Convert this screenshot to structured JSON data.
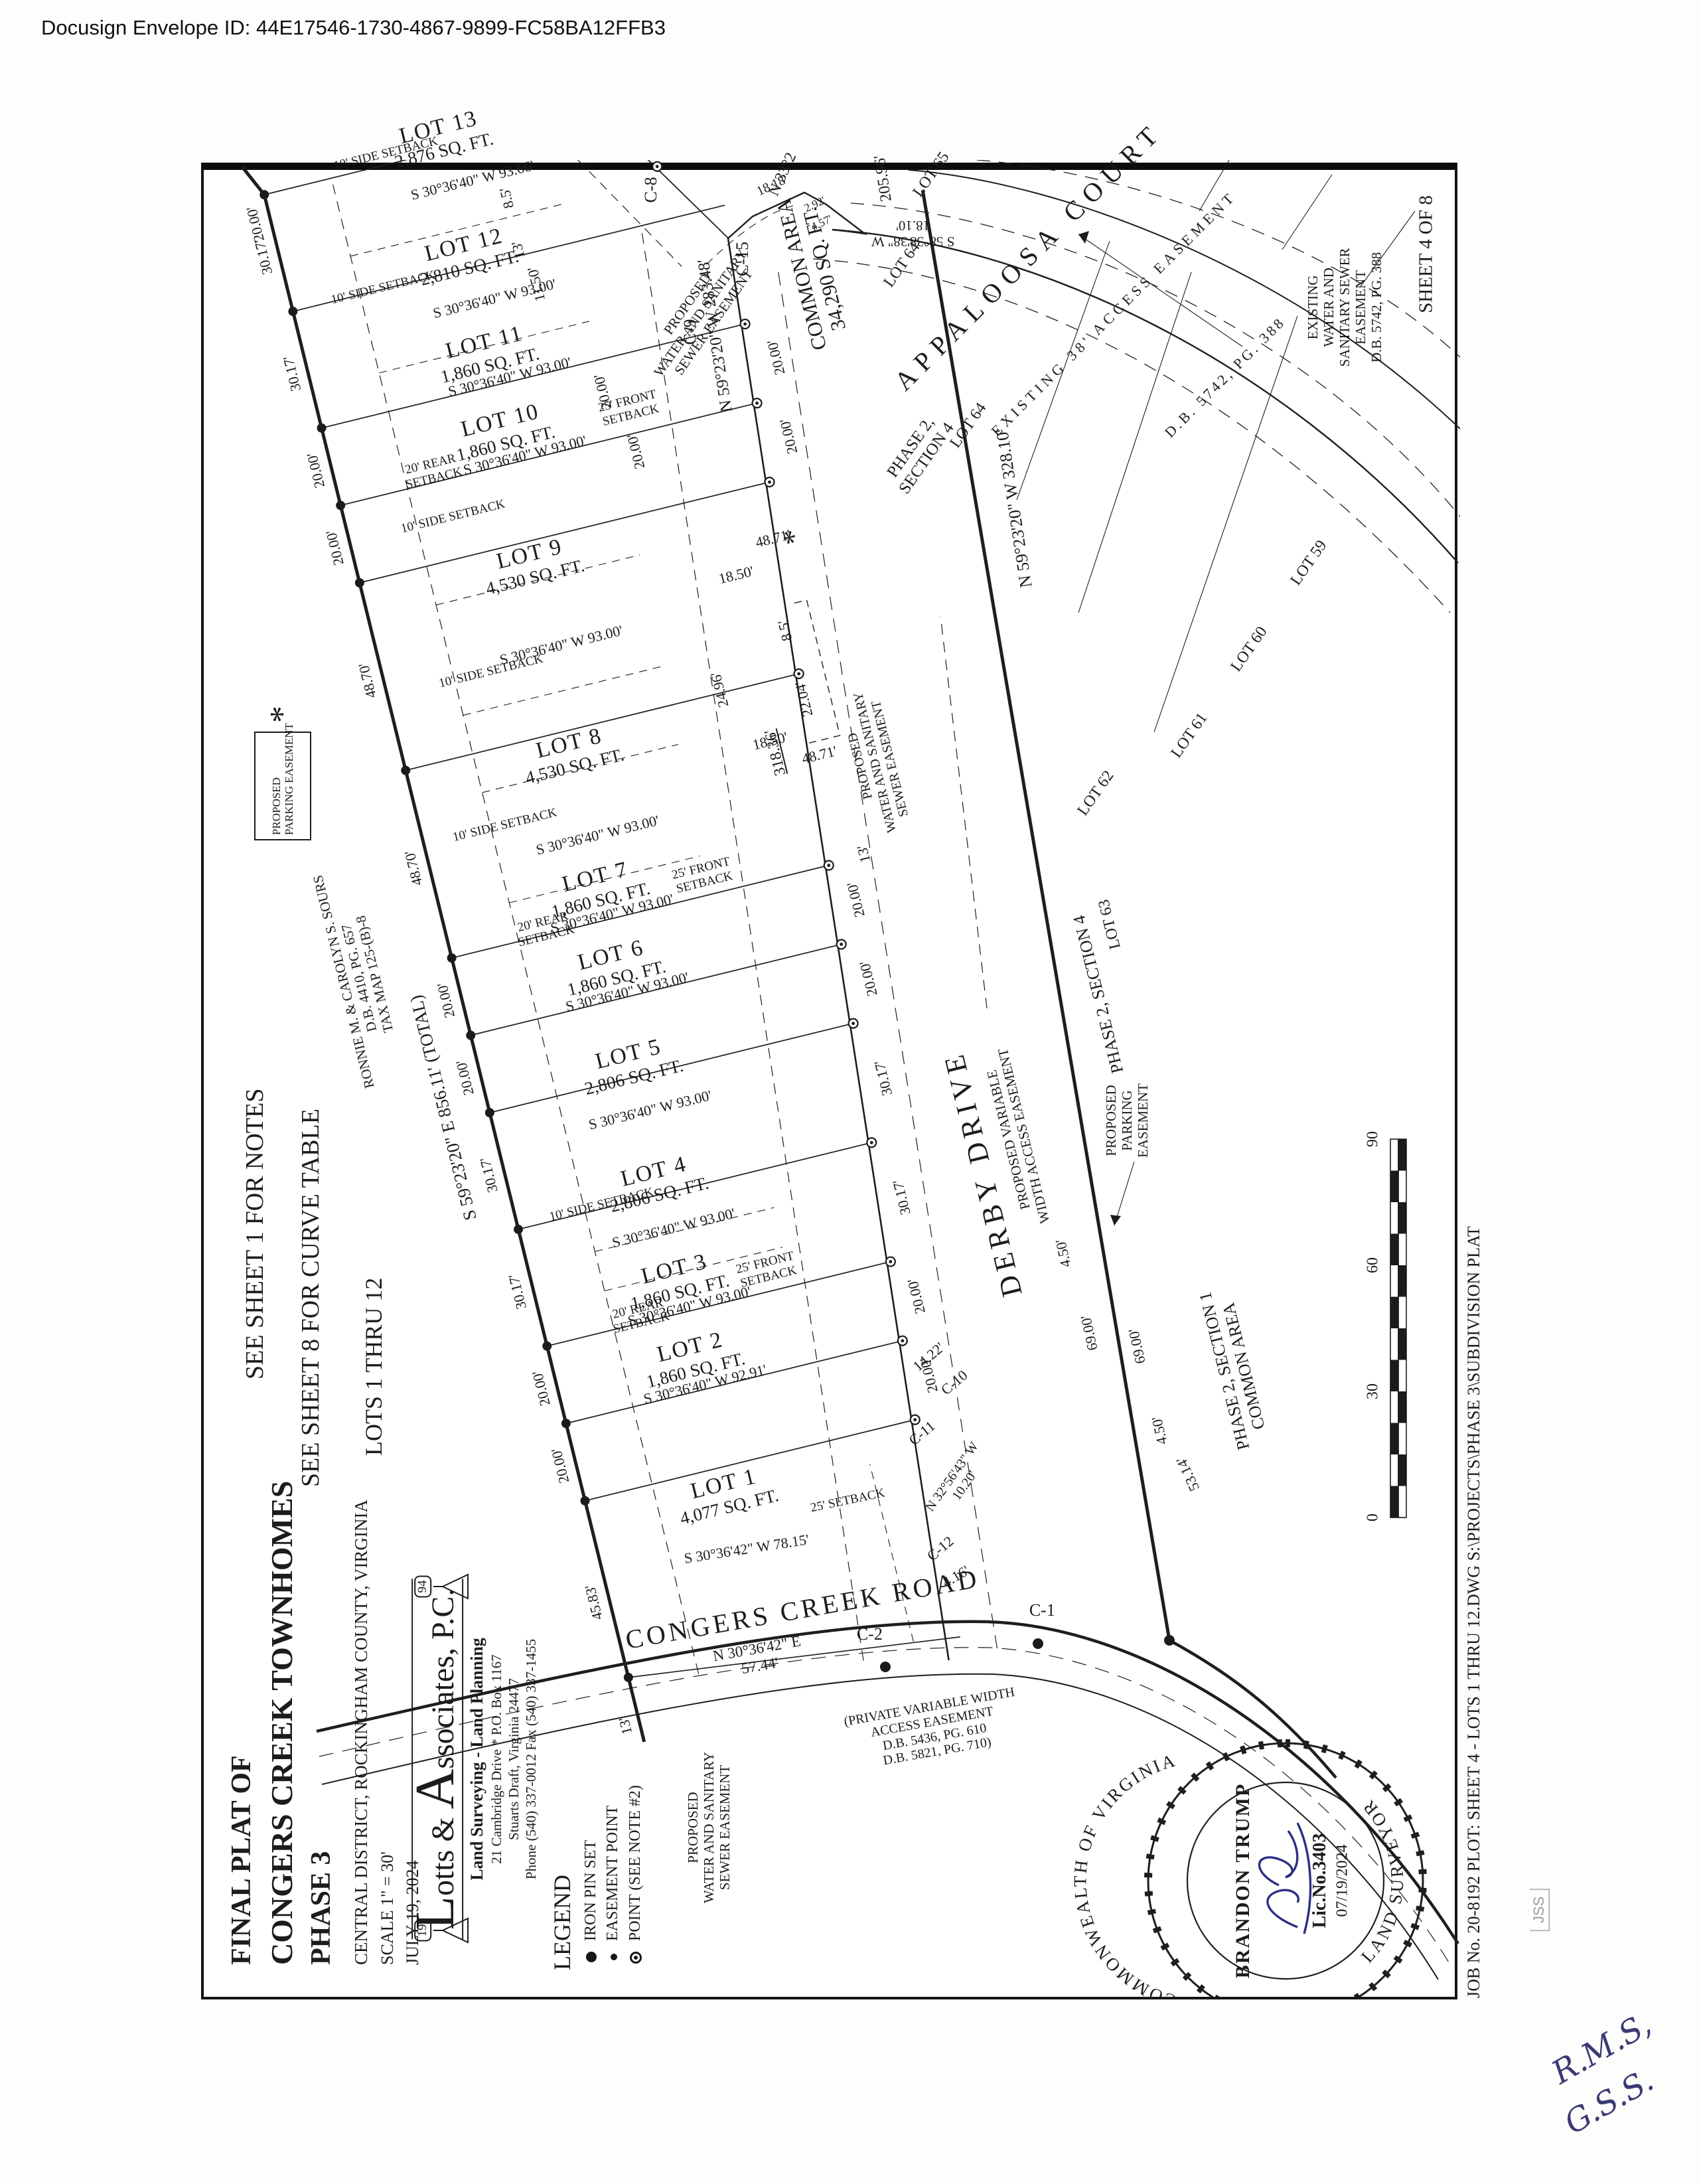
{
  "page": {
    "docusign_id": "Docusign Envelope ID: 44E17546-1730-4867-9899-FC58BA12FFB3",
    "sheet_label": "SHEET 4 OF 8",
    "job_line": "JOB No. 20-8192   PLOT: SHEET 4 - LOTS 1 THRU 12.DWG S:\\PROJECTS\\PHASE 3\\SUBDIVISION PLAT",
    "handwriting_line1": "R.M.S,",
    "handwriting_line2": "G.S.S.",
    "stamp": "JSS"
  },
  "title_block": {
    "line1": "FINAL PLAT OF",
    "line2": "CONGERS CREEK TOWNHOMES",
    "line3": "PHASE 3",
    "location": "CENTRAL DISTRICT, ROCKINGHAM COUNTY, VIRGINIA",
    "scale": "SCALE 1\" = 30'",
    "date": "JULY 19, 2024"
  },
  "firm": {
    "initial_l": "L",
    "name_mid": "otts & ",
    "initial_a": "A",
    "name_end": "ssociates, P.C.",
    "est_left": "19",
    "est_right": "94",
    "tagline": "Land Surveying - Land Planning",
    "addr1": "21 Cambridge Drive * P.O. Box 1167",
    "addr2": "Stuarts Draft, Virginia 24477",
    "addr3": "Phone (540) 337-0012 Fax (540) 337-1455"
  },
  "legend": {
    "title": "LEGEND",
    "item1": "IRON PIN SET",
    "item2": "EASEMENT POINT",
    "item3": "POINT (SEE NOTE #2)"
  },
  "notes": {
    "note1": "SEE SHEET 1 FOR NOTES",
    "note2": "SEE SHEET 8 FOR CURVE TABLE",
    "note3": "LOTS 1 THRU 12"
  },
  "lots": [
    {
      "name": "LOT 1",
      "area": "4,077 SQ. FT.",
      "frontage": "45.83'",
      "bearing": "S 30°36'42\" W  78.15'",
      "setback": "25' SETBACK"
    },
    {
      "name": "LOT 2",
      "area": "1,860 SQ. FT.",
      "frontage": "20.00'",
      "bearing": "S 30°36'40\" W  92.91'"
    },
    {
      "name": "LOT 3",
      "area": "1,860 SQ. FT.",
      "frontage": "20.00'",
      "bearing": "S 30°36'40\" W  93.00'"
    },
    {
      "name": "LOT 4",
      "area": "2,806 SQ. FT.",
      "frontage": "30.17'",
      "bearing": "S 30°36'40\" W  93.00'"
    },
    {
      "name": "LOT 5",
      "area": "2,806 SQ. FT.",
      "frontage": "30.17'",
      "bearing": "S 30°36'40\" W  93.00'"
    },
    {
      "name": "LOT 6",
      "area": "1,860 SQ. FT.",
      "frontage": "20.00'",
      "bearing": "S 30°36'40\" W  93.00'"
    },
    {
      "name": "LOT 7",
      "area": "1,860 SQ. FT.",
      "frontage": "20.00'",
      "bearing": "S 30°36'40\" W  93.00'"
    },
    {
      "name": "LOT 8",
      "area": "4,530 SQ. FT.",
      "frontage": "48.70'",
      "bearing": "S 30°36'40\" W  93.00'"
    },
    {
      "name": "LOT 9",
      "area": "4,530 SQ. FT.",
      "frontage": "48.70'",
      "bearing": "S 30°36'40\" W  93.00'"
    },
    {
      "name": "LOT 10",
      "area": "1,860 SQ. FT.",
      "frontage": "20.00'",
      "bearing": "S 30°36'40\" W  93.00'"
    },
    {
      "name": "LOT 11",
      "area": "1,860 SQ. FT.",
      "frontage": "20.00'",
      "bearing": "S 30°36'40\" W  93.00'"
    },
    {
      "name": "LOT 12",
      "area": "2,810 SQ. FT.",
      "frontage": "30.17'",
      "bearing": "S 30°36'40\" W  93.00'"
    },
    {
      "name": "LOT 13",
      "area": "2,876 SQ. FT.",
      "frontage": "30.17'",
      "bearing": "S 30°36'40\" W  93.66'"
    }
  ],
  "boundary": {
    "total_bearing": "S 59°23'20\" E  856.11' (TOTAL)",
    "owner1": "RONNIE M. & CAROLYN S. SOURS",
    "owner2": "D.B. 4410, PG. 657",
    "owner3": "TAX MAP 125-(B)-8",
    "front_283": "N 59°23'20\" W  283.48'",
    "front_318": "318.36'",
    "south_328": "N 59°23'20\" W  328.10'",
    "d205": "205.96'",
    "congers_brg": "N 30°36'42\" E",
    "congers_dist": "57.44'",
    "n33": "N 33°2",
    "s58": "S 58°38'38\" W",
    "s58_dist": "18.10'",
    "n3256": "N 32°56'43\" W",
    "n3256_dist": "10.20'"
  },
  "roads": {
    "derby": "DERBY DRIVE",
    "derby_sub1": "PROPOSED VARIABLE",
    "derby_sub2": "WIDTH ACCESS EASEMENT",
    "congers": "CONGERS CREEK ROAD",
    "congers_sub1": "(PRIVATE VARIABLE WIDTH",
    "congers_sub2": "ACCESS EASEMENT",
    "congers_sub3": "D.B. 5436, PG. 610",
    "congers_sub4": "D.B. 5821, PG. 710)",
    "appaloosa": "APPALOOSA COURT",
    "app_ease": "EXISTING 38' ACCESS EASEMENT",
    "app_ease_db": "D.B. 5742, PG. 388"
  },
  "easements": {
    "prop1": "PROPOSED",
    "prop2": "WATER AND SANITARY",
    "prop3": "SEWER EASEMENT",
    "exist1": "EXISTING",
    "exist2": "WATER AND",
    "exist3": "SANITARY SEWER",
    "exist4": "EASEMENT",
    "exist5": "D.B. 5742, PG. 388",
    "park1": "PROPOSED",
    "park2": "PARKING EASEMENT",
    "park_star": "*",
    "park_b1": "PROPOSED",
    "park_b2": "PARKING",
    "park_b3": "EASEMENT"
  },
  "areas": {
    "common1": "COMMON AREA",
    "common2": "34,290 SQ. FT.",
    "p21a": "PHASE 2, SECTION 1",
    "p21b": "COMMON AREA",
    "p24a": "PHASE 2,",
    "p24b": "SECTION 4",
    "p24_flat": "PHASE 2, SECTION 4",
    "lot59": "LOT 59",
    "lot60": "LOT 60",
    "lot61": "LOT 61",
    "lot62": "LOT 62",
    "lot63": "LOT 63",
    "lot64": "LOT 64",
    "lot65": "LOT 65"
  },
  "curves": {
    "c1": "C-1",
    "c2": "C-2",
    "c8": "C-8",
    "c9": "C-9",
    "c10": "C-10",
    "c11": "C-11",
    "c12": "C-12",
    "c15": "C-15"
  },
  "setbacks": {
    "rear": "20' REAR",
    "rear2": "SETBACK",
    "front": "25' FRONT",
    "front2": "SETBACK",
    "side": "10' SIDE SETBACK"
  },
  "dims": {
    "d450": "4.50'",
    "d6900": "69.00'",
    "d5314": "53.14'",
    "d416": "4.16'",
    "d1422": "14.22'",
    "d13": "13'",
    "d85": "8.5'",
    "d1150": "11.50'",
    "d2000": "20.00'",
    "d3017": "30.17'",
    "d1850": "18.50'",
    "d4871": "48.71'",
    "d2496": "24.96'",
    "d2204": "22.04'",
    "d1818": "18.18'",
    "d292": "2.92'",
    "d457": "4.57'"
  },
  "seal": {
    "arc_top": "COMMONWEALTH OF VIRGINIA",
    "arc_bottom": "LAND SURVEYOR",
    "name": "BRANDON TRUMP",
    "lic": "Lic.No.3403",
    "date": "07/19/2024"
  },
  "scalebar": {
    "t0": "0",
    "t30": "30",
    "t60": "60",
    "t90": "90"
  }
}
